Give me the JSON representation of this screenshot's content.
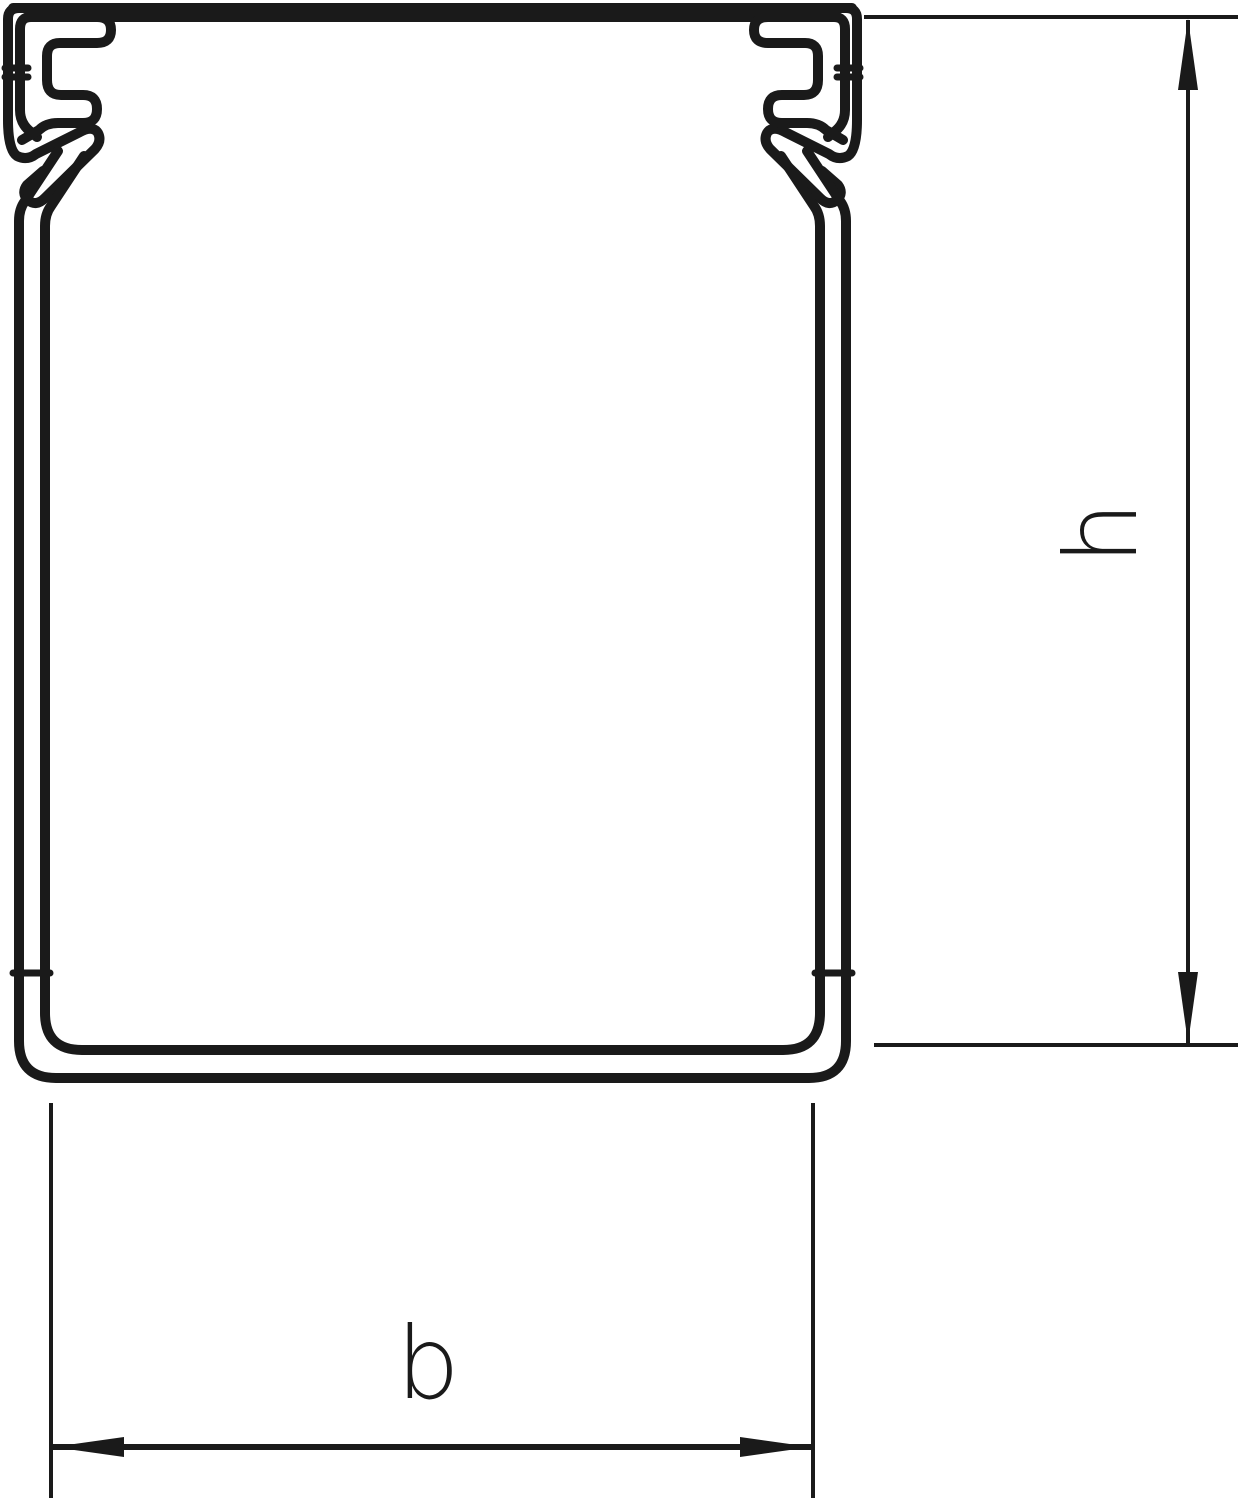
{
  "figure": {
    "kind": "technical cross-section drawing of a cable trunking / wiring duct profile",
    "labels": {
      "height": "h",
      "width": "b"
    },
    "colors": {
      "line": "#1a1a1a",
      "background": "#ffffff"
    }
  }
}
